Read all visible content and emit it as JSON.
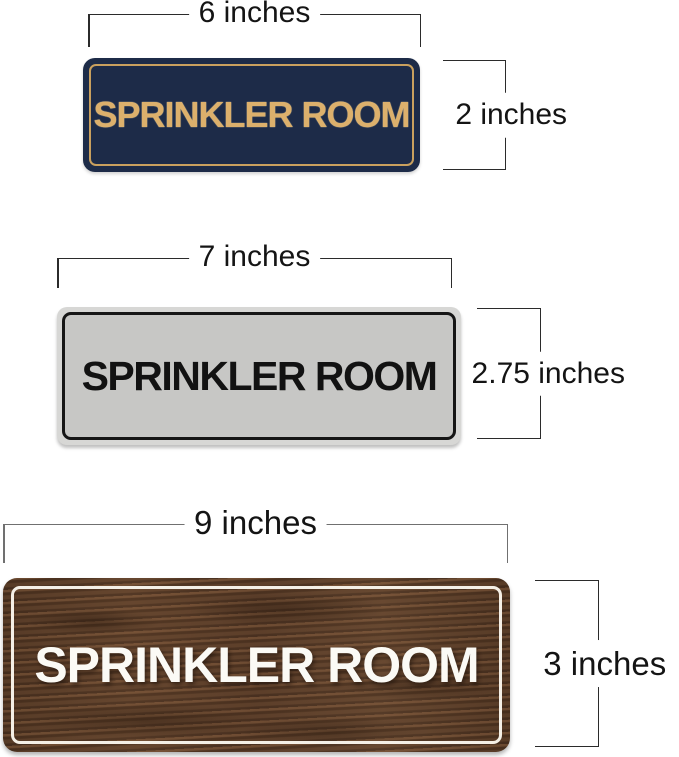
{
  "signs": [
    {
      "style": "navy-blue-gold",
      "label": "SPRINKLER ROOM",
      "width_label": "6 inches",
      "height_label": "2 inches",
      "colors": {
        "background": "#1d2b48",
        "border": "#c9a05e",
        "text": "#dcb06c"
      }
    },
    {
      "style": "silver-black",
      "label": "SPRINKLER ROOM",
      "width_label": "7 inches",
      "height_label": "2.75 inches",
      "colors": {
        "background": "#c7c7c5",
        "rim": "#d7d7d5",
        "border": "#161616",
        "text": "#121212"
      }
    },
    {
      "style": "walnut-wood-white",
      "label": "SPRINKLER ROOM",
      "width_label": "9 inches",
      "height_label": "3 inches",
      "colors": {
        "background": "#5b3e2b",
        "border": "#f4efe6",
        "text": "#fbfaf5"
      }
    }
  ],
  "dimension_line_colors": {
    "default": "#2b2b2b",
    "bottom_width": "#707070"
  }
}
